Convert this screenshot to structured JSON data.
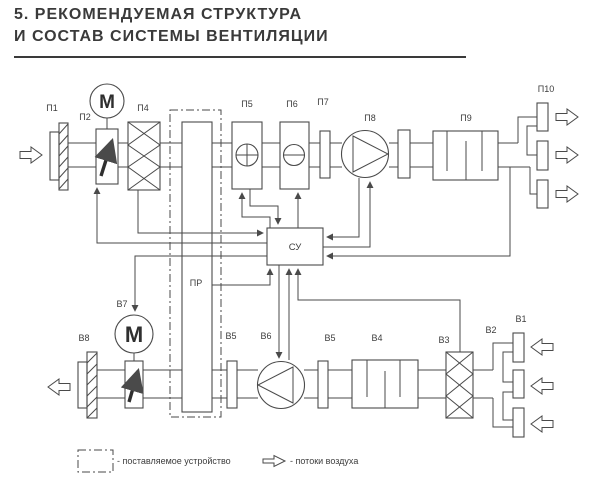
{
  "title": {
    "line1": "5. РЕКОМЕНДУЕМАЯ СТРУКТУРА",
    "line2": "И СОСТАВ СИСТЕМЫ ВЕНТИЛЯЦИИ"
  },
  "diagram": {
    "labels": {
      "p1": "П1",
      "p2": "П2",
      "p4": "П4",
      "p5": "П5",
      "p6": "П6",
      "p7": "П7",
      "p8": "П8",
      "p9": "П9",
      "p10": "П10",
      "pr": "ПР",
      "su": "СУ",
      "v1": "В1",
      "v2": "В2",
      "v3": "В3",
      "v4": "В4",
      "v5": "В5",
      "v6": "В6",
      "v7": "В7",
      "v8": "В8",
      "motor": "M"
    }
  },
  "legend": {
    "supplied_device": "- поставляемое устройство",
    "air_flows": "- потоки воздуха"
  },
  "colors": {
    "line": "#4a4a4a",
    "title": "#3a3a3a",
    "background": "#ffffff"
  }
}
